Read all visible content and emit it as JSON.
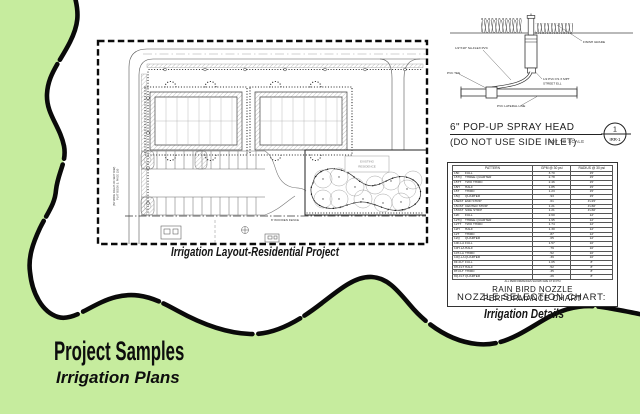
{
  "page": {
    "background_color": "#c6ec9e",
    "border_line_color": "#0a0a0a",
    "title": "Project Samples",
    "subtitle": "Irrigation Plans"
  },
  "site_plan": {
    "caption": "Irrigation Layout-Residential Project",
    "labels": {
      "existing_1": "EXISTING",
      "existing_2": "RESIDENCE",
      "wooden_fence": "8' WOODEN FENCE",
      "right_of_way": "(50' WIDE RIGHT-OF-WAY R/W)",
      "plat": "PLAT BOOK 5, PAGE 150"
    }
  },
  "spray_head_detail": {
    "title": "6\" POP-UP SPRAY HEAD",
    "subtitle": "(DO NOT USE SIDE INLET)",
    "scale_note": "NOT TO SCALE",
    "detail_number": "1",
    "detail_sheet": "IRR-1",
    "labels": {
      "flex_pipe": "1/2\"X18\" SA-FLEX PVC",
      "pvc_tee": "PVC TEE",
      "finish_grade": "FINISH GRADE",
      "street_ell_1": "1/2 PVC FS X MPT",
      "street_ell_2": "STREET ELL",
      "lateral_line": "PVC LATERAL LINE"
    }
  },
  "nozzle_chart": {
    "columns": [
      "PATTERN",
      "GPM @ 30 psi",
      "RADIUS @ 30 psi"
    ],
    "rows": [
      {
        "code": "15F",
        "name": "FULL",
        "gpm": "3.70",
        "radius": "15'"
      },
      {
        "code": "15TQ",
        "name": "THREE QUARTER",
        "gpm": "2.78",
        "radius": "15'"
      },
      {
        "code": "15TT",
        "name": "TWO THIRD",
        "gpm": "2.46",
        "radius": "15'"
      },
      {
        "code": "15H",
        "name": "HALF",
        "gpm": "1.85",
        "radius": "15'"
      },
      {
        "code": "15T",
        "name": "THIRD",
        "gpm": "1.23",
        "radius": "15'"
      },
      {
        "code": "15Q",
        "name": "QUARTER",
        "gpm": ".93",
        "radius": "15'"
      },
      {
        "code": "15EST",
        "name": "END STRIP",
        "gpm": ".61",
        "radius": "4'x15'"
      },
      {
        "code": "15CST",
        "name": "CENTER STRIP",
        "gpm": "1.21",
        "radius": "4'x30'"
      },
      {
        "code": "15SST",
        "name": "SIDE STRIP",
        "gpm": "1.21",
        "radius": "4'x30'"
      },
      {
        "code": "12F",
        "name": "FULL",
        "gpm": "2.60",
        "radius": "12'"
      },
      {
        "code": "12TQ",
        "name": "THREE QUARTER",
        "gpm": "1.95",
        "radius": "12'"
      },
      {
        "code": "12TT",
        "name": "TWO THIRD",
        "gpm": "1.74",
        "radius": "12'"
      },
      {
        "code": "12H",
        "name": "HALF",
        "gpm": "1.30",
        "radius": "12'"
      },
      {
        "code": "12T",
        "name": "THIRD",
        "gpm": ".87",
        "radius": "12'"
      },
      {
        "code": "12Q",
        "name": "QUARTER",
        "gpm": ".65",
        "radius": "12'"
      },
      {
        "code": "10F-LA",
        "name": "FULL",
        "gpm": "1.57",
        "radius": "10'"
      },
      {
        "code": "10H-LA",
        "name": "HALF",
        "gpm": ".79",
        "radius": "10'"
      },
      {
        "code": "10T-LA",
        "name": "THIRD",
        "gpm": ".52",
        "radius": "10'"
      },
      {
        "code": "10Q-LA",
        "name": "QUARTER",
        "gpm": ".39",
        "radius": "10'"
      },
      {
        "code": "8F-FLT",
        "name": "FULL",
        "gpm": "1.05",
        "radius": "8'"
      },
      {
        "code": "8H-FLT",
        "name": "HALF",
        "gpm": ".52",
        "radius": "8'"
      },
      {
        "code": "8T-FLT",
        "name": "THIRD",
        "gpm": ".35",
        "radius": "8'"
      },
      {
        "code": "8Q-FLT",
        "name": "QUARTER",
        "gpm": ".26",
        "radius": "8'"
      }
    ],
    "note": "ALL PERFORMANCES SHOWN ARE AT 30 PSI",
    "title_line1": "RAIN BIRD NOZZLE",
    "title_line2": "PERFORMANCE CHART"
  },
  "details_section": {
    "selection_chart_label": "NOZZLE SELECTION CHART:",
    "caption": "Irrigation Details"
  }
}
